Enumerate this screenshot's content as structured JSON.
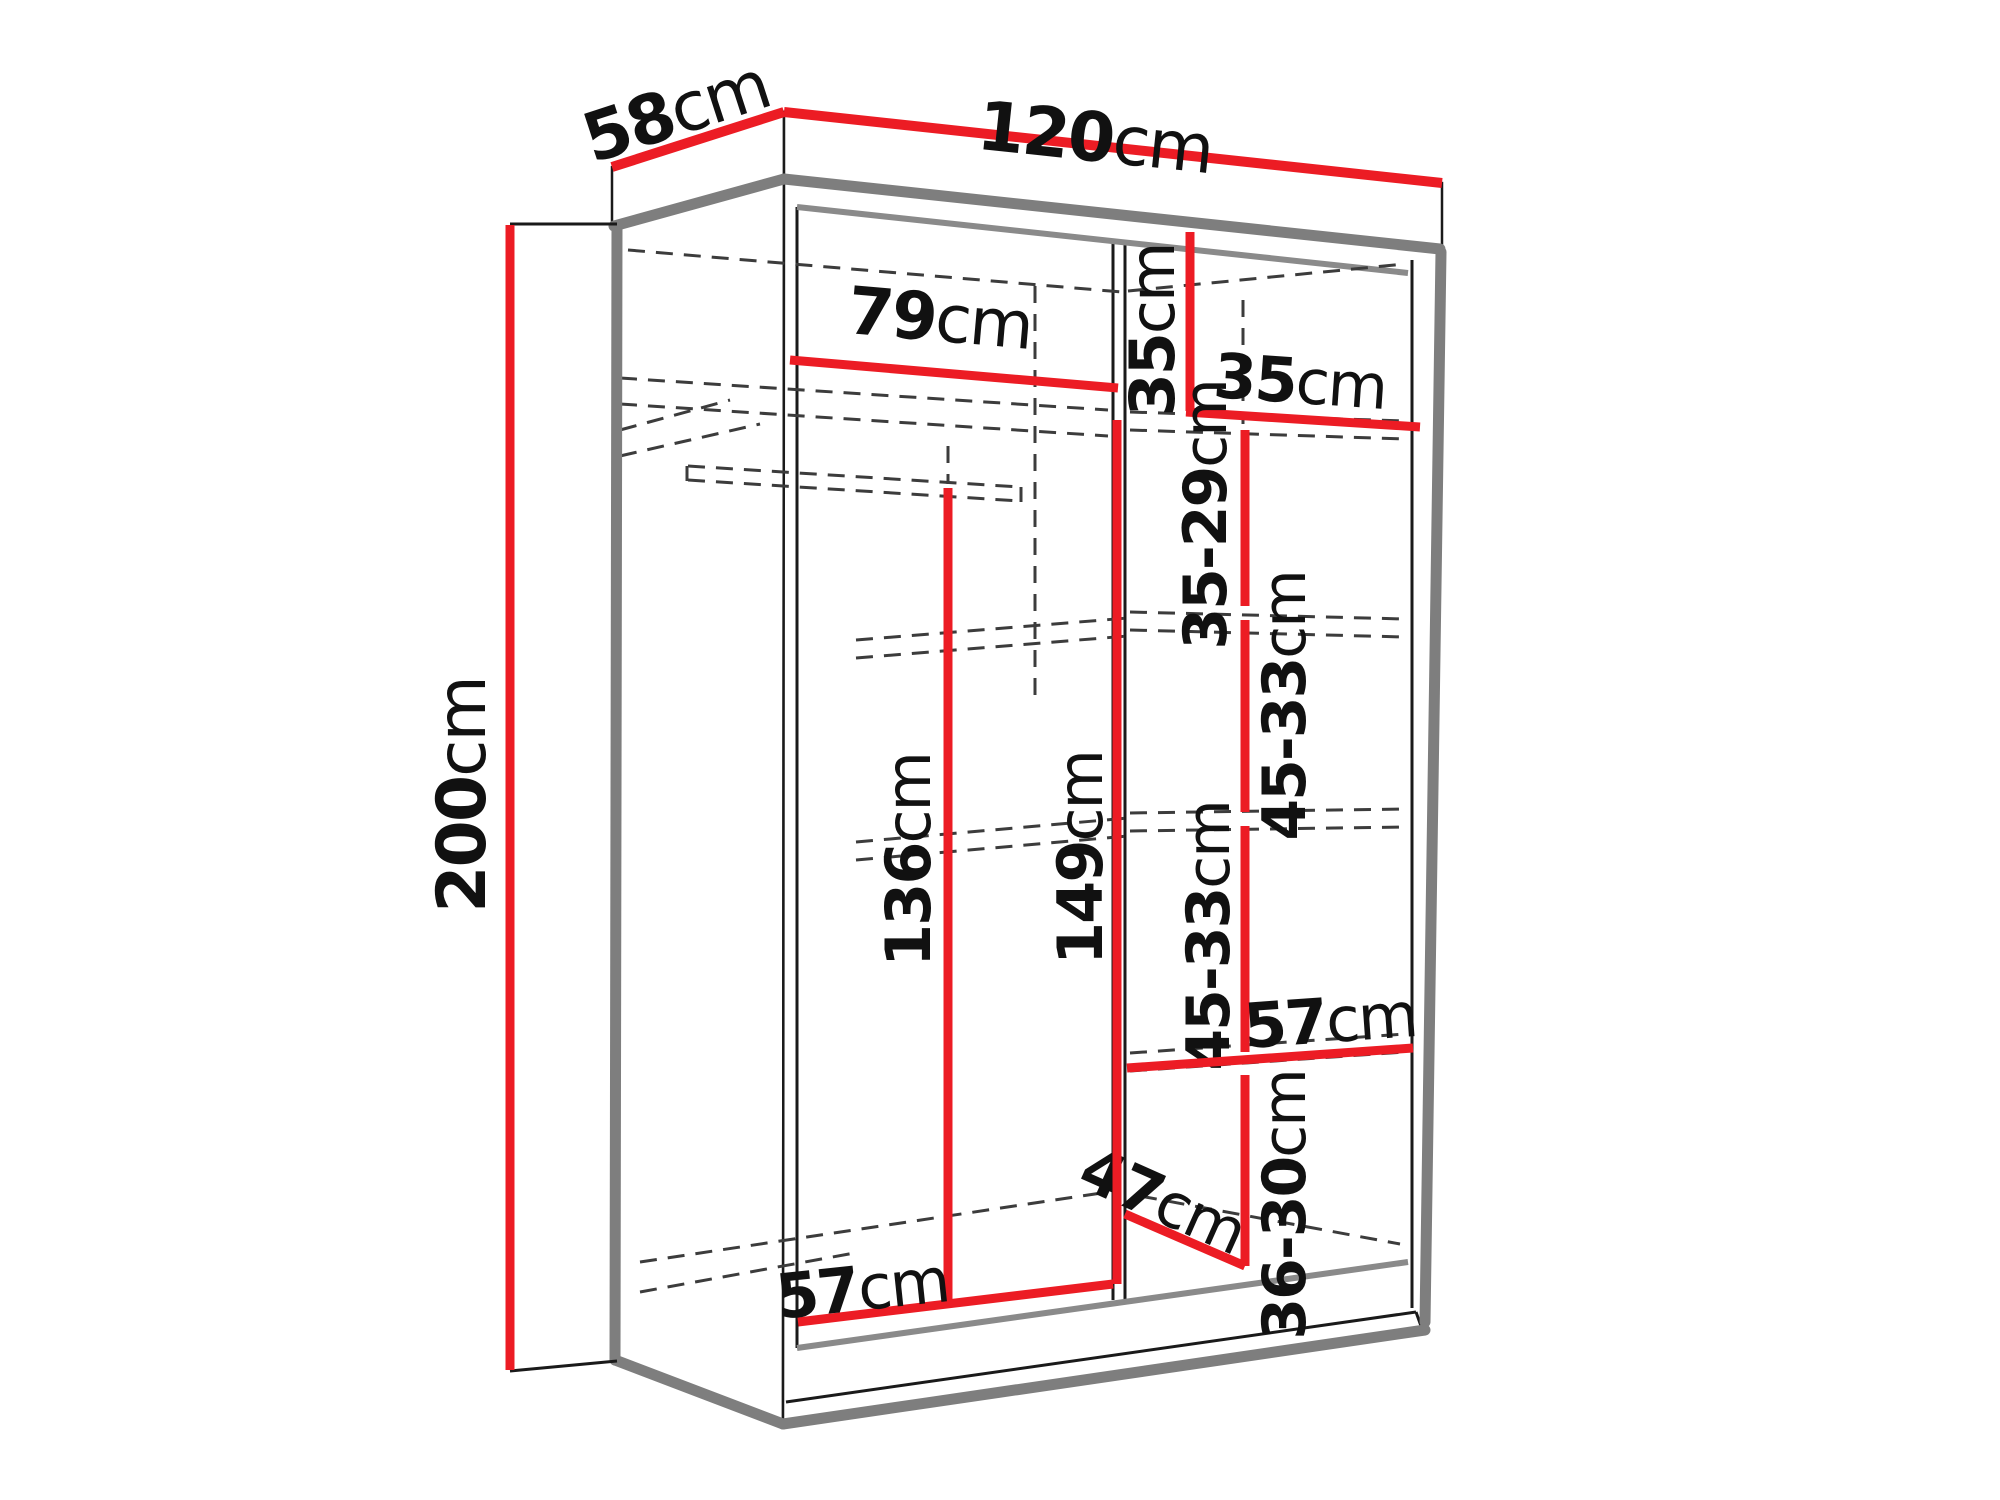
{
  "diagram": {
    "title": "Sliding wardrobe interior dimensions diagram",
    "unit": "cm",
    "colors": {
      "dimension_red": "#ec1c24",
      "edge_black": "#1a1a1a",
      "outline_gray": "#7e7e7e",
      "hidden_dash": "#3c3c3c",
      "background": "#ffffff",
      "text": "#111111"
    },
    "dimensions": [
      {
        "id": "top-width",
        "value": "120",
        "unit": "cm",
        "line": [
          [
            784,
            112,
            1442,
            183
          ]
        ],
        "width": 10,
        "label": {
          "x": 1095,
          "y": 138,
          "rotate": 6,
          "size": 68
        }
      },
      {
        "id": "top-depth",
        "value": "58",
        "unit": "cm",
        "line": [
          [
            612,
            167,
            784,
            112
          ]
        ],
        "width": 10,
        "label": {
          "x": 676,
          "y": 112,
          "rotate": -18,
          "size": 68
        }
      },
      {
        "id": "height",
        "value": "200",
        "unit": "cm",
        "line": [
          [
            510,
            225,
            510,
            1370
          ]
        ],
        "width": 9,
        "ticks": [
          [
            510,
            224,
            617,
            224
          ],
          [
            510,
            1371,
            617,
            1361
          ]
        ],
        "label": {
          "x": 462,
          "y": 795,
          "rotate": -90,
          "size": 68
        }
      },
      {
        "id": "left-interior-width",
        "value": "79",
        "unit": "cm",
        "line": [
          [
            790,
            360,
            1118,
            388
          ]
        ],
        "width": 9,
        "label": {
          "x": 940,
          "y": 318,
          "rotate": 5,
          "size": 66
        }
      },
      {
        "id": "right-top-height",
        "value": "35",
        "unit": "cm",
        "line": [
          [
            1190,
            232,
            1190,
            411
          ]
        ],
        "width": 9,
        "label": {
          "x": 1152,
          "y": 330,
          "rotate": -90,
          "size": 62
        }
      },
      {
        "id": "right-top-width",
        "value": "35",
        "unit": "cm",
        "line": [
          [
            1186,
            412,
            1420,
            427
          ]
        ],
        "width": 9,
        "label": {
          "x": 1300,
          "y": 381,
          "rotate": 4,
          "size": 62
        }
      },
      {
        "id": "right-gap-1",
        "value": "35-29",
        "unit": "cm",
        "line": [
          [
            1245,
            430,
            1245,
            606
          ]
        ],
        "width": 9,
        "label": {
          "x": 1206,
          "y": 515,
          "rotate": -90,
          "size": 60
        }
      },
      {
        "id": "right-gap-2",
        "value": "45-33",
        "unit": "cm",
        "line": [
          [
            1245,
            620,
            1245,
            812
          ]
        ],
        "width": 9,
        "label": {
          "x": 1285,
          "y": 706,
          "rotate": -90,
          "size": 60
        }
      },
      {
        "id": "right-gap-3",
        "value": "45-33",
        "unit": "cm",
        "line": [
          [
            1245,
            826,
            1245,
            1052
          ]
        ],
        "width": 9,
        "label": {
          "x": 1209,
          "y": 936,
          "rotate": -90,
          "size": 60
        }
      },
      {
        "id": "right-gap-4",
        "value": "36-30",
        "unit": "cm",
        "line": [
          [
            1245,
            1075,
            1245,
            1266
          ]
        ],
        "width": 9,
        "label": {
          "x": 1285,
          "y": 1205,
          "rotate": -90,
          "size": 60
        }
      },
      {
        "id": "right-shelf-width",
        "value": "57",
        "unit": "cm",
        "line": [
          [
            1127,
            1068,
            1413,
            1048
          ]
        ],
        "width": 9,
        "label": {
          "x": 1330,
          "y": 1020,
          "rotate": -4,
          "size": 62
        }
      },
      {
        "id": "bottom-diagonal",
        "value": "47",
        "unit": "cm",
        "line": [
          [
            1125,
            1214,
            1245,
            1266
          ]
        ],
        "width": 9,
        "label": {
          "x": 1163,
          "y": 1200,
          "rotate": 24,
          "size": 62
        }
      },
      {
        "id": "hanging-height",
        "value": "136",
        "unit": "cm",
        "line": [
          [
            948,
            488,
            948,
            1304
          ]
        ],
        "width": 9,
        "label": {
          "x": 908,
          "y": 860,
          "rotate": -90,
          "size": 62
        }
      },
      {
        "id": "interior-height",
        "value": "149",
        "unit": "cm",
        "line": [
          [
            1117,
            420,
            1117,
            1284
          ]
        ],
        "width": 9,
        "label": {
          "x": 1080,
          "y": 858,
          "rotate": -90,
          "size": 62
        }
      },
      {
        "id": "bottom-interior-width",
        "value": "57",
        "unit": "cm",
        "line": [
          [
            798,
            1322,
            1113,
            1284
          ]
        ],
        "width": 9,
        "label": {
          "x": 862,
          "y": 1288,
          "rotate": -6,
          "size": 62
        }
      }
    ]
  }
}
